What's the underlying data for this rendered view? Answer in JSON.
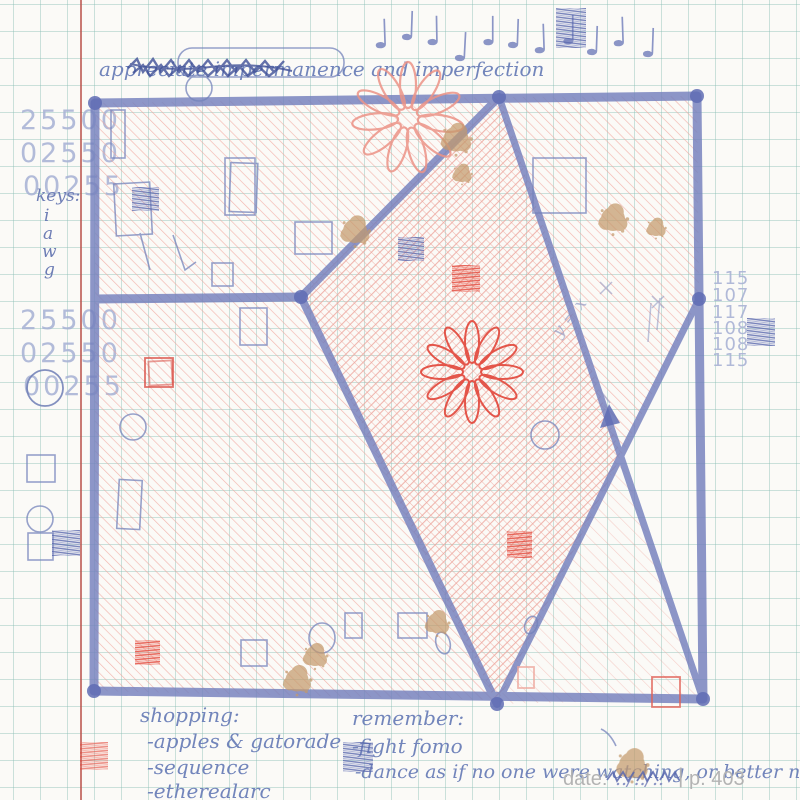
{
  "notebook": {
    "title": "appreciate impermanence and imperfection",
    "music": {
      "glyph": "♩",
      "count": 11
    },
    "left_margin": {
      "upper_numbers": [
        "25500",
        "02550",
        "00255"
      ],
      "keys_label": "keys:",
      "keys": [
        "i",
        "a",
        "w",
        "g"
      ],
      "lower_numbers": [
        "25500",
        "02550",
        "00255"
      ]
    },
    "right_margin": {
      "numbers": [
        "115",
        "107",
        "117",
        "108",
        "108",
        "115"
      ]
    },
    "sketch_annotation": "y = x",
    "shopping": {
      "title": "shopping:",
      "items": [
        "-apples & gatorade",
        "-sequence",
        "-etherealarc"
      ]
    },
    "remember": {
      "title": "remember:",
      "items": [
        "-fight fomo",
        "-dance as if no one were watching, or better not"
      ]
    },
    "footer": {
      "date_label": "date:",
      "date_value": "../../..",
      "separator": "|",
      "page_number": "p. 403"
    },
    "icons": [
      "quarter-note",
      "flower-doodle",
      "coffee-stain",
      "hatched-square",
      "arrow-up"
    ],
    "colors": {
      "paper": "#fbfaf7",
      "grid_line": "#9cc6c0",
      "margin_line": "#bb544e",
      "ink_blue": "#7480bd",
      "ink_blue_dark": "#4a5a9a",
      "handwriting_blue": "#7285bb",
      "faded_number_blue": "#a9b3d5",
      "hatch_red": "#f0a49b",
      "ink_red": "#e3493c",
      "stain_brown": "#c49a6c",
      "footer_gray": "#b3b3b3"
    }
  }
}
